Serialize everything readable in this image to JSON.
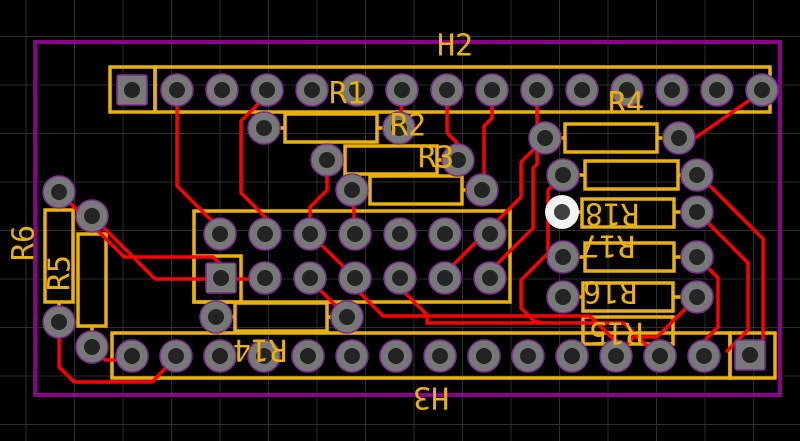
{
  "app": {
    "view": "pcb-layout-canvas"
  },
  "pcb": {
    "canvas": {
      "width": 800,
      "height": 441,
      "background": "#000000"
    },
    "grid": {
      "spacing": 48.5,
      "offset_x": 26,
      "offset_y": 36.5,
      "color": "#2d2d2d"
    },
    "colors": {
      "silk": "#e9b109",
      "trace": "#fc0000",
      "outline": "#8b008b",
      "pad_fill": "#787878",
      "pad_ring": "#7a2e8f",
      "hole": "#242424",
      "selected_pad_fill": "#f2f2f2",
      "selected_hole": "#3f3f3f",
      "label": "#e9b109"
    },
    "board_outline": {
      "x": 35,
      "y": 42,
      "w": 745,
      "h": 353,
      "stroke": 4
    },
    "headers": [
      {
        "ref": "H2",
        "boxes": [
          {
            "x": 110,
            "y": 67,
            "w": 45,
            "h": 45
          },
          {
            "x": 155,
            "y": 67,
            "w": 615,
            "h": 45
          }
        ],
        "square_pads": [
          {
            "x": 132,
            "y": 90
          }
        ],
        "round_pads_y": 90,
        "round_pads_x": [
          177,
          222,
          267,
          312,
          357,
          402,
          447,
          492,
          537,
          582,
          627,
          672,
          717,
          762
        ]
      },
      {
        "ref": "connector-mid",
        "boxes": [
          {
            "x": 194,
            "y": 211,
            "w": 316,
            "h": 91
          },
          {
            "x": 194,
            "y": 256,
            "w": 47,
            "h": 46
          }
        ],
        "square_pads": [
          {
            "x": 221,
            "y": 278
          }
        ],
        "round_rows": [
          {
            "y": 234,
            "x": [
              220,
              265,
              310,
              355,
              400,
              445,
              490
            ]
          },
          {
            "y": 278,
            "x": [
              265,
              310,
              355,
              400,
              445,
              490
            ]
          }
        ]
      },
      {
        "ref": "H3",
        "boxes": [
          {
            "x": 112,
            "y": 333,
            "w": 618,
            "h": 45
          },
          {
            "x": 730,
            "y": 333,
            "w": 45,
            "h": 45
          }
        ],
        "square_pads": [
          {
            "x": 750,
            "y": 355
          }
        ],
        "round_pads_y": 356,
        "round_pads_x": [
          132,
          176,
          220,
          264,
          308,
          352,
          396,
          440,
          484,
          528,
          572,
          616,
          660,
          704
        ]
      }
    ],
    "resistors": [
      {
        "ref": "R1",
        "orient": "h",
        "body": [
          285,
          114,
          92,
          28
        ],
        "pads": [
          {
            "x": 264,
            "y": 128
          },
          {
            "x": 399,
            "y": 128
          }
        ]
      },
      {
        "ref": "R2",
        "orient": "h",
        "body": [
          345,
          146,
          92,
          28
        ],
        "pads": [
          {
            "x": 327,
            "y": 160
          },
          {
            "x": 458,
            "y": 160
          }
        ]
      },
      {
        "ref": "R3",
        "orient": "h",
        "body": [
          370,
          176,
          92,
          28
        ],
        "pads": [
          {
            "x": 352,
            "y": 190
          },
          {
            "x": 482,
            "y": 190
          }
        ]
      },
      {
        "ref": "R4",
        "orient": "h",
        "body": [
          565,
          124,
          92,
          28
        ],
        "pads": [
          {
            "x": 545,
            "y": 138
          },
          {
            "x": 679,
            "y": 138
          }
        ]
      },
      {
        "ref": "R-mid",
        "orient": "h",
        "body": [
          585,
          161,
          93,
          28
        ],
        "pads": [
          {
            "x": 563,
            "y": 175
          },
          {
            "x": 697,
            "y": 175
          }
        ]
      },
      {
        "ref": "R18",
        "orient": "h",
        "body": [
          582,
          199,
          92,
          28
        ],
        "pads": [
          {
            "x": 562,
            "y": 212,
            "selected": true
          },
          {
            "x": 697,
            "y": 212
          }
        ]
      },
      {
        "ref": "R17",
        "orient": "h",
        "body": [
          585,
          243,
          89,
          28
        ],
        "pads": [
          {
            "x": 563,
            "y": 257
          },
          {
            "x": 697,
            "y": 257
          }
        ]
      },
      {
        "ref": "R16",
        "orient": "h",
        "body": [
          583,
          283,
          90,
          28
        ],
        "pads": [
          {
            "x": 563,
            "y": 297
          },
          {
            "x": 697,
            "y": 297
          }
        ]
      },
      {
        "ref": "R15",
        "orient": "h",
        "body": [
          583,
          317,
          90,
          27
        ],
        "pads": []
      },
      {
        "ref": "R14",
        "orient": "h",
        "body": [
          235,
          303,
          92,
          28
        ],
        "pads": [
          {
            "x": 216,
            "y": 317
          },
          {
            "x": 347,
            "y": 317
          }
        ]
      },
      {
        "ref": "R5",
        "orient": "v",
        "body": [
          45,
          210,
          28,
          92
        ],
        "pads": [
          {
            "x": 59,
            "y": 192
          },
          {
            "x": 59,
            "y": 322
          }
        ]
      },
      {
        "ref": "R6",
        "orient": "v",
        "body": [
          78,
          234,
          28,
          92
        ],
        "pads": [
          {
            "x": 92,
            "y": 216
          },
          {
            "x": 92,
            "y": 347
          }
        ]
      }
    ],
    "labels": [
      {
        "text": "H2",
        "x": 455,
        "y": 46,
        "rot": 0
      },
      {
        "text": "R1",
        "x": 347,
        "y": 94,
        "rot": 0
      },
      {
        "text": "R2",
        "x": 408,
        "y": 126,
        "rot": 0
      },
      {
        "text": "R3",
        "x": 436,
        "y": 158,
        "rot": 0
      },
      {
        "text": "R4",
        "x": 626,
        "y": 104,
        "rot": 0
      },
      {
        "text": "R5",
        "x": 60,
        "y": 273,
        "rot": -90
      },
      {
        "text": "R6",
        "x": 24,
        "y": 243,
        "rot": -90
      },
      {
        "text": "R14",
        "x": 260,
        "y": 349,
        "rot": 180
      },
      {
        "text": "R15",
        "x": 616,
        "y": 332,
        "rot": 180
      },
      {
        "text": "R16",
        "x": 610,
        "y": 291,
        "rot": 180
      },
      {
        "text": "R17",
        "x": 608,
        "y": 245,
        "rot": 180
      },
      {
        "text": "R18",
        "x": 612,
        "y": 213,
        "rot": 180
      },
      {
        "text": "H3",
        "x": 431,
        "y": 397,
        "rot": 180
      }
    ],
    "traces": [
      [
        [
          177,
          95
        ],
        [
          177,
          186
        ],
        [
          220,
          229
        ],
        [
          220,
          234
        ]
      ],
      [
        [
          267,
          95
        ],
        [
          241,
          121
        ],
        [
          241,
          193
        ],
        [
          265,
          217
        ],
        [
          265,
          234
        ]
      ],
      [
        [
          402,
          95
        ],
        [
          400,
          128
        ]
      ],
      [
        [
          447,
          95
        ],
        [
          447,
          133
        ],
        [
          458,
          144
        ],
        [
          458,
          160
        ]
      ],
      [
        [
          492,
          95
        ],
        [
          492,
          118
        ],
        [
          484,
          126
        ],
        [
          484,
          190
        ]
      ],
      [
        [
          537,
          95
        ],
        [
          537,
          164
        ],
        [
          533,
          168
        ],
        [
          533,
          228
        ],
        [
          490,
          271
        ],
        [
          490,
          277
        ]
      ],
      [
        [
          545,
          138
        ],
        [
          521,
          162
        ],
        [
          521,
          197
        ],
        [
          474,
          244
        ],
        [
          445,
          273
        ],
        [
          445,
          277
        ]
      ],
      [
        [
          754,
          97
        ],
        [
          695,
          138
        ],
        [
          681,
          138
        ]
      ],
      [
        [
          697,
          173
        ],
        [
          712,
          188
        ],
        [
          763,
          239
        ],
        [
          763,
          345
        ],
        [
          757,
          351
        ]
      ],
      [
        [
          697,
          212
        ],
        [
          748,
          263
        ],
        [
          748,
          330
        ],
        [
          727,
          351
        ]
      ],
      [
        [
          697,
          257
        ],
        [
          718,
          278
        ],
        [
          718,
          327
        ],
        [
          706,
          339
        ],
        [
          706,
          355
        ]
      ],
      [
        [
          697,
          297
        ],
        [
          657,
          337
        ],
        [
          634,
          337
        ],
        [
          616,
          355
        ]
      ],
      [
        [
          563,
          175
        ],
        [
          548,
          190
        ],
        [
          548,
          253
        ],
        [
          521,
          280
        ],
        [
          521,
          308
        ],
        [
          535,
          322
        ],
        [
          540,
          322
        ]
      ],
      [
        [
          327,
          160
        ],
        [
          327,
          190
        ],
        [
          310,
          207
        ],
        [
          310,
          234
        ]
      ],
      [
        [
          352,
          190
        ],
        [
          354,
          212
        ],
        [
          354,
          234
        ]
      ],
      [
        [
          355,
          288
        ],
        [
          383,
          316
        ],
        [
          590,
          316
        ],
        [
          616,
          342
        ],
        [
          616,
          352
        ]
      ],
      [
        [
          400,
          288
        ],
        [
          427,
          315
        ],
        [
          427,
          323
        ],
        [
          624,
          323
        ],
        [
          656,
          355
        ],
        [
          660,
          355
        ]
      ],
      [
        [
          310,
          234
        ],
        [
          353,
          276
        ],
        [
          353,
          277
        ]
      ],
      [
        [
          59,
          192
        ],
        [
          124,
          257
        ],
        [
          213,
          257
        ],
        [
          221,
          265
        ],
        [
          221,
          278
        ]
      ],
      [
        [
          92,
          216
        ],
        [
          155,
          279
        ],
        [
          255,
          279
        ],
        [
          265,
          277
        ]
      ],
      [
        [
          59,
          322
        ],
        [
          59,
          367
        ],
        [
          74,
          382
        ],
        [
          152,
          382
        ],
        [
          176,
          357
        ]
      ],
      [
        [
          92,
          347
        ],
        [
          105,
          360
        ],
        [
          126,
          360
        ],
        [
          132,
          357
        ]
      ],
      [
        [
          347,
          317
        ],
        [
          325,
          295
        ],
        [
          310,
          281
        ],
        [
          310,
          277
        ]
      ]
    ],
    "pad_geometry": {
      "round_r": 16,
      "hole_r": 8,
      "square_size": 30,
      "silk_stroke": 3.5,
      "trace_stroke": 3.5,
      "label_font_size": 30
    }
  }
}
